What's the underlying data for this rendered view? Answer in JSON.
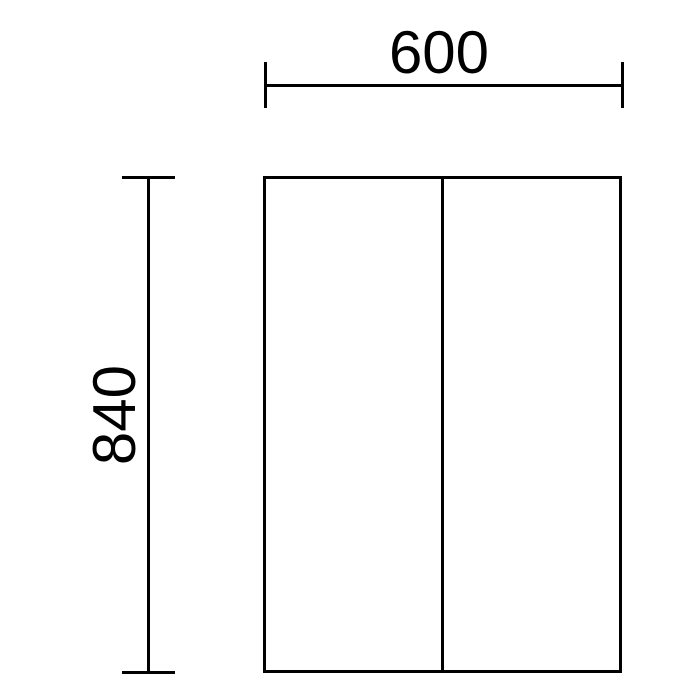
{
  "drawing": {
    "background_color": "#ffffff",
    "line_color": "#000000",
    "dimensions": {
      "width": {
        "label": "600",
        "value": 600
      },
      "height": {
        "label": "840",
        "value": 840
      }
    }
  }
}
